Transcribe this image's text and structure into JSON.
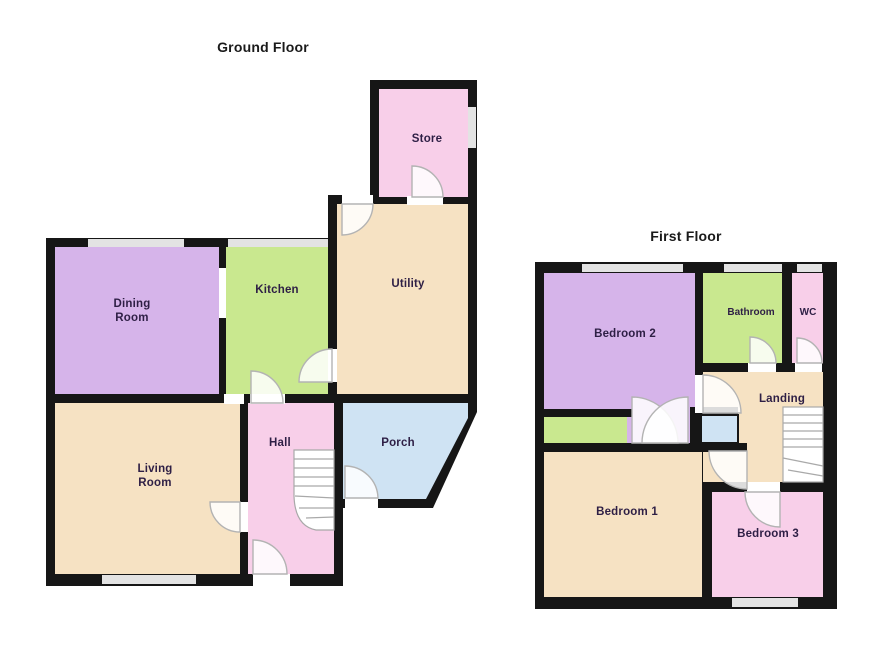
{
  "palette": {
    "wall": "#161616",
    "purple": "#d6b4ea",
    "green": "#c9e88f",
    "tan": "#f6e2c3",
    "pink": "#f8cfe9",
    "blue": "#cfe3f3",
    "window": "#e3e3e3",
    "door_arc": "#b3b3b3",
    "stair": "#a9a9a9",
    "label": "#2e1f45",
    "title": "#1a1a1a"
  },
  "ground": {
    "title": "Ground Floor",
    "rooms": {
      "store": "Store",
      "utility": "Utility",
      "kitchen": "Kitchen",
      "dining_l1": "Dining",
      "dining_l2": "Room",
      "living_l1": "Living",
      "living_l2": "Room",
      "hall": "Hall",
      "porch": "Porch"
    }
  },
  "first": {
    "title": "First Floor",
    "rooms": {
      "bedroom2": "Bedroom 2",
      "bathroom": "Bathroom",
      "wc": "WC",
      "landing": "Landing",
      "bedroom1": "Bedroom 1",
      "bedroom3": "Bedroom 3"
    }
  }
}
